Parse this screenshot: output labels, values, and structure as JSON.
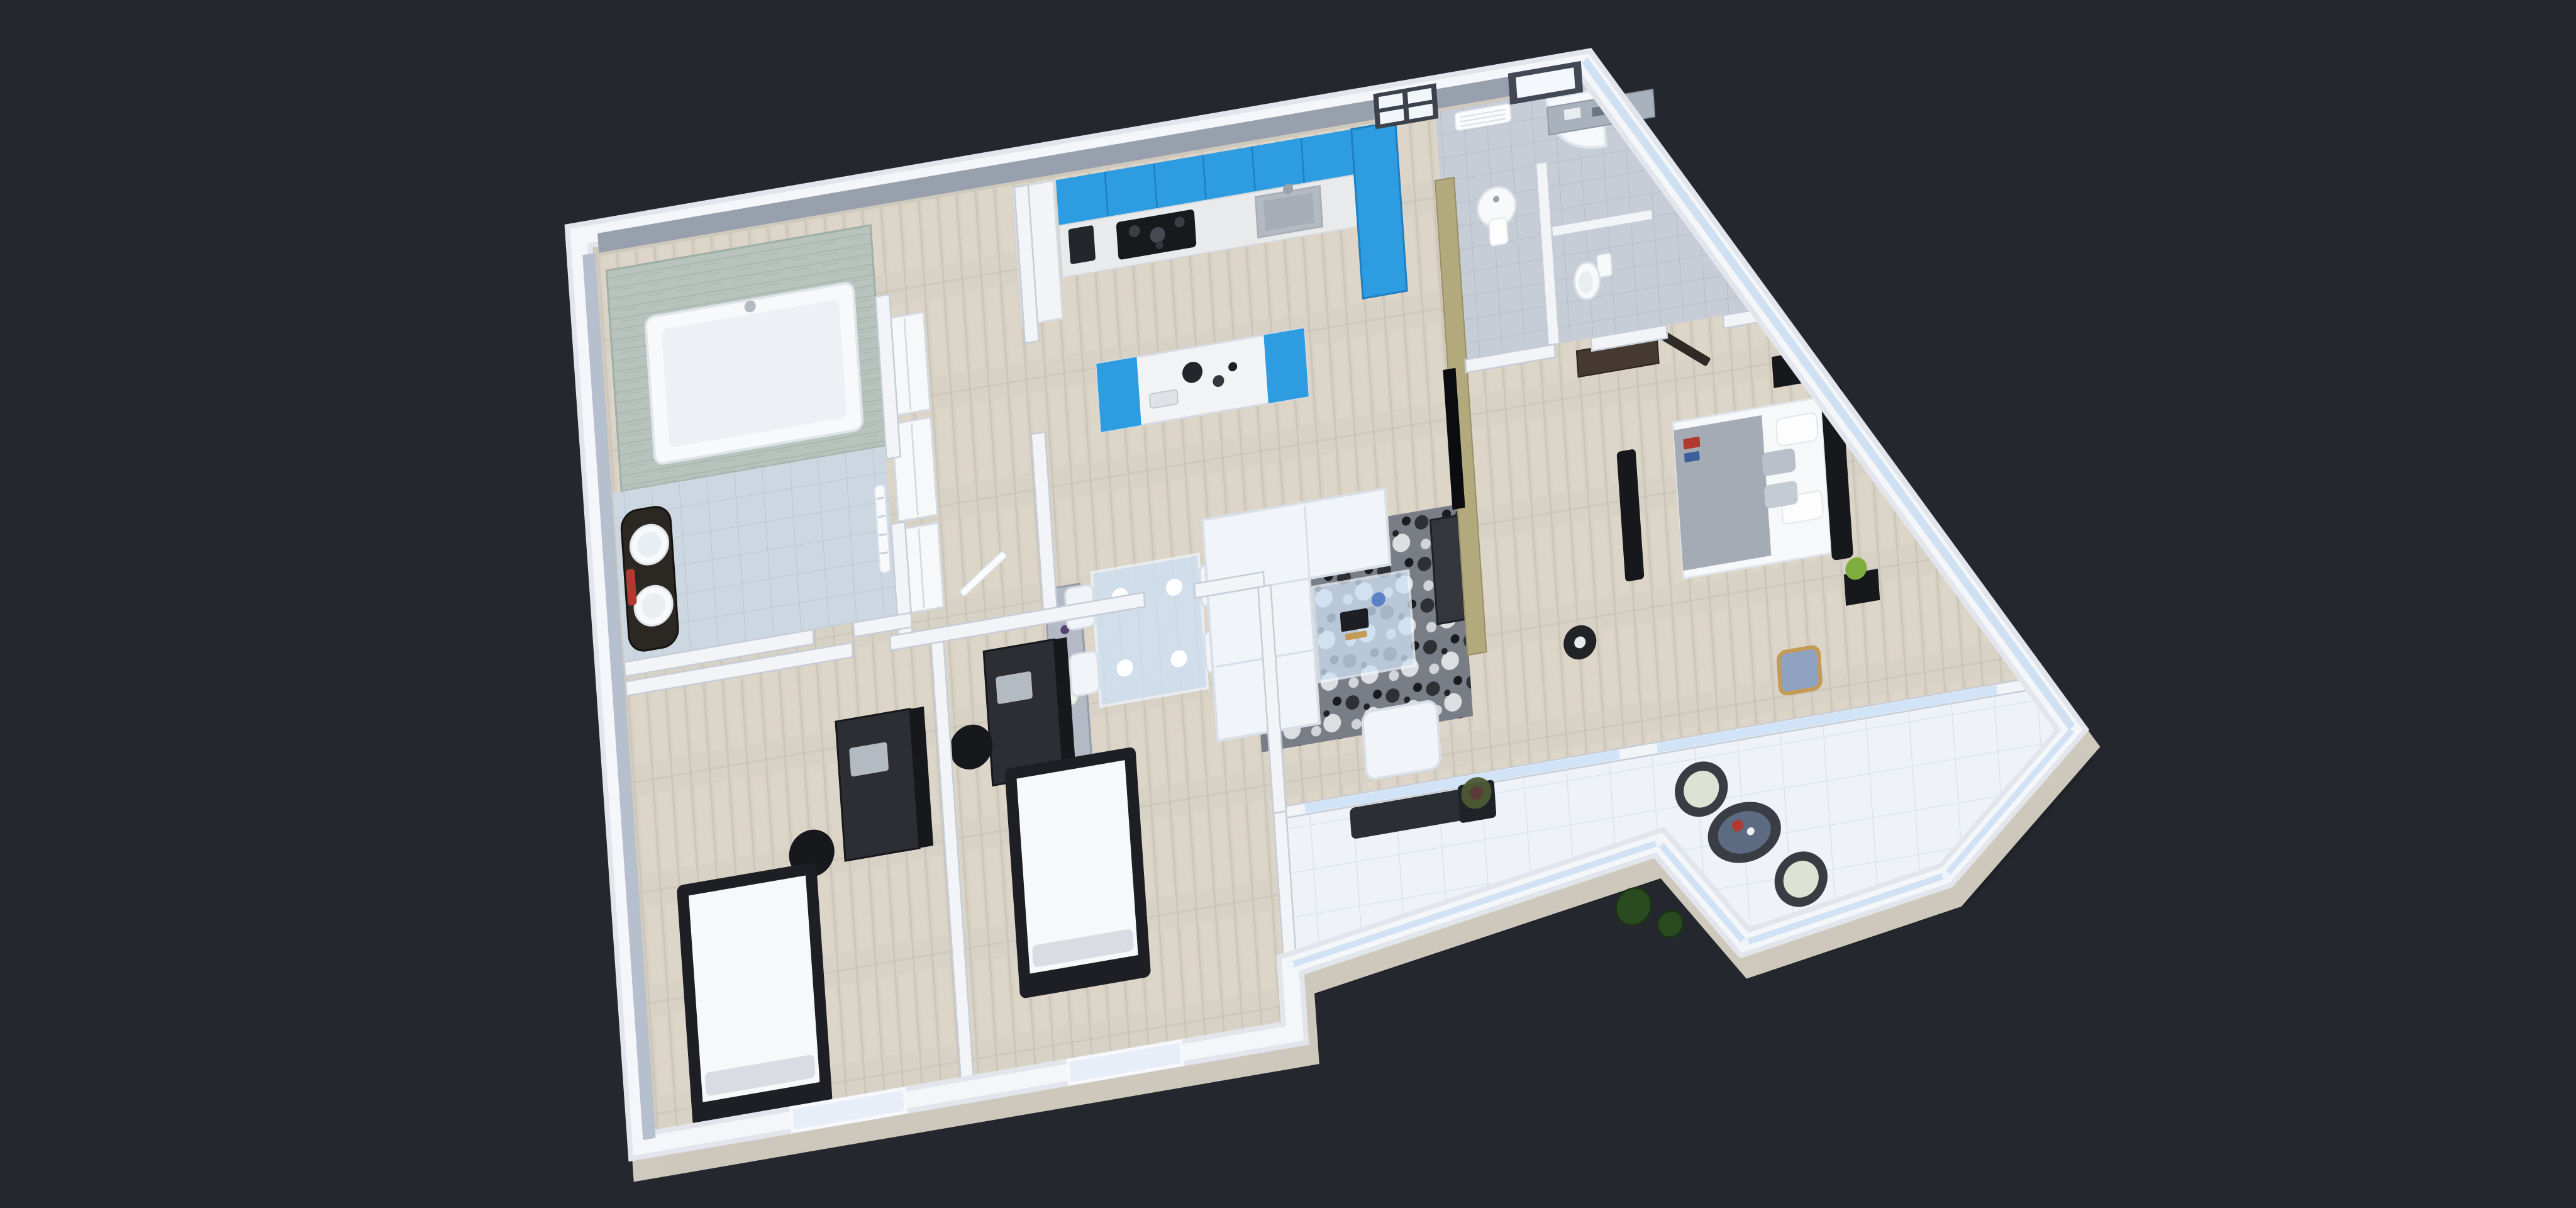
{
  "scene": {
    "type": "3d-floor-plan-render",
    "view": "isometric-top-down",
    "rooms": [
      {
        "id": "bathroom-main",
        "name": "bathroom with tub and double vanity"
      },
      {
        "id": "hallway",
        "name": "entry hallway with closets"
      },
      {
        "id": "kitchen",
        "name": "blue kitchen with island"
      },
      {
        "id": "dining",
        "name": "dining area with glass table"
      },
      {
        "id": "living",
        "name": "living room with white sofas"
      },
      {
        "id": "wc",
        "name": "toilet room"
      },
      {
        "id": "bathroom-2",
        "name": "second bathroom with shower and pedestal sink"
      },
      {
        "id": "master-bedroom",
        "name": "master bedroom"
      },
      {
        "id": "bedroom-2",
        "name": "kid bedroom with desk (left)"
      },
      {
        "id": "bedroom-3",
        "name": "kid bedroom with desk (middle)"
      },
      {
        "id": "terrace",
        "name": "white tiled terrace with rattan set"
      }
    ],
    "furniture": [
      "bathtub",
      "vanity-double-sink",
      "towel-ladder",
      "closets",
      "fridge-column",
      "upper-cabinets",
      "cooktop",
      "kitchen-sink",
      "coffee-machine",
      "tall-cabinet",
      "kitchen-island",
      "glass-door",
      "window",
      "towel-radiator",
      "pedestal-sink",
      "shower-tray",
      "toilet",
      "counter",
      "sideboard",
      "dining-table",
      "dining-chairs",
      "sofa-l-shape",
      "armchair",
      "rug",
      "coffee-table",
      "tv",
      "tv-console",
      "floor-lamp",
      "double-bed",
      "nightstands",
      "bench",
      "accent-chair",
      "wardrobe",
      "single-bed-1",
      "single-bed-2",
      "desk-1",
      "desk-2",
      "office-chairs",
      "terrace-bench",
      "planter",
      "rattan-chairs",
      "rattan-table",
      "topiary-pots"
    ]
  },
  "colors": {
    "background": "#24282e",
    "shadow": "#1c2025",
    "footing": "#d8d2c4",
    "wall_rim": "#e2e6ec",
    "wall_top": "#f4f6f9",
    "wall_fill": "#f2f4f7",
    "wall_edge": "#c7cdd6",
    "wall_north": "#98a0ad",
    "wall_west": "#b6bfce",
    "glass_edge": "#cfe0f3",
    "wood_base": "#d8d1c5",
    "wood_seam": "#c3bbad",
    "wood_light": "#e3dccf",
    "bathtile": "#ccd7e2",
    "bathtile_line": "#b7c5d3",
    "wctile": "#c6cdd7",
    "wctile_line": "#b4bcc8",
    "tertile": "#eff3f9",
    "tertile_line": "#dbe3ee",
    "stone_green": "#b7c3bc",
    "stone_streak": "#a6b4ac",
    "kitchen_blue": "#2d9ce0",
    "kitchen_blue_dark": "#1f7fc0",
    "counter": "#e9eaec",
    "cooktop": "#17191d",
    "stainless": "#b4bac1",
    "khaki": "#b2a97c",
    "khaki_edge": "#978f66",
    "sofa": "#f1f4f8",
    "sofa_edge": "#d9dfe7",
    "rug_base": "#787d86",
    "glass": "#cfe2f5",
    "dark_furniture": "#2a2d33",
    "black": "#17181c",
    "porcelain": "#f7f9fb",
    "porcelain_edge": "#dde2e8",
    "bedding": "#f6f8fa",
    "blanket": "#a4abb4",
    "brown_wardrobe": "#453931",
    "wood_chair": "#c49a55",
    "cushion_blue": "#8fa3c0",
    "plant_green": "#7fae3f",
    "plant_dark": "#2a4a20",
    "red_accent": "#b03a32",
    "blue_accent": "#5b82c4",
    "rattan": "#393c42",
    "rattan_cushion": "#dde2d4",
    "sideboard": "#b3bac6",
    "lamp_black": "#212327",
    "tv_black": "#0b0c0f",
    "console_gray": "#33363c"
  }
}
